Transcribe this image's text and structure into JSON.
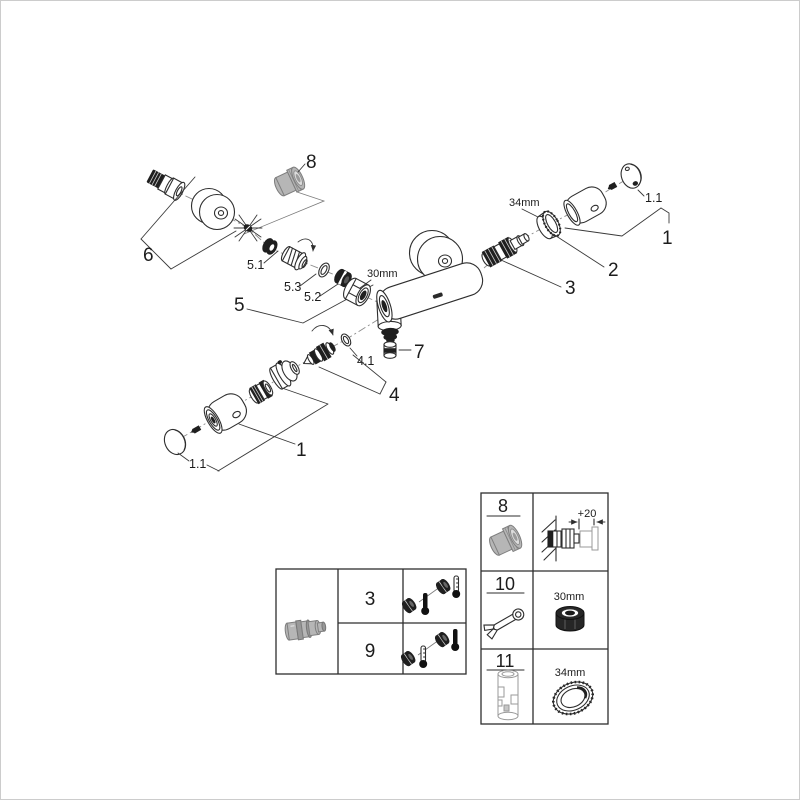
{
  "labels": {
    "part8_top": "8",
    "part6": "6",
    "part5": "5",
    "part5_1": "5.1",
    "part5_2": "5.2",
    "part5_3": "5.3",
    "nut_size": "30mm",
    "ring_size": "34mm",
    "part1_right": "1",
    "part1_1_right": "1.1",
    "part2": "2",
    "part3": "3",
    "part7": "7",
    "part4": "4",
    "part4_1": "4.1",
    "part1_left": "1",
    "part1_1_left": "1.1"
  },
  "tables": {
    "accessory": {
      "rows": [
        {
          "id": "8",
          "dim": "+20"
        },
        {
          "id": "10",
          "dim": "30mm"
        },
        {
          "id": "11",
          "dim": "34mm"
        }
      ]
    },
    "variants": {
      "rows": [
        {
          "id": "3"
        },
        {
          "id": "9"
        }
      ]
    }
  },
  "colors": {
    "line": "#2e2e2e",
    "part_gray": "#b6b6b6",
    "background": "#ffffff",
    "page_border": "#cccccc"
  }
}
